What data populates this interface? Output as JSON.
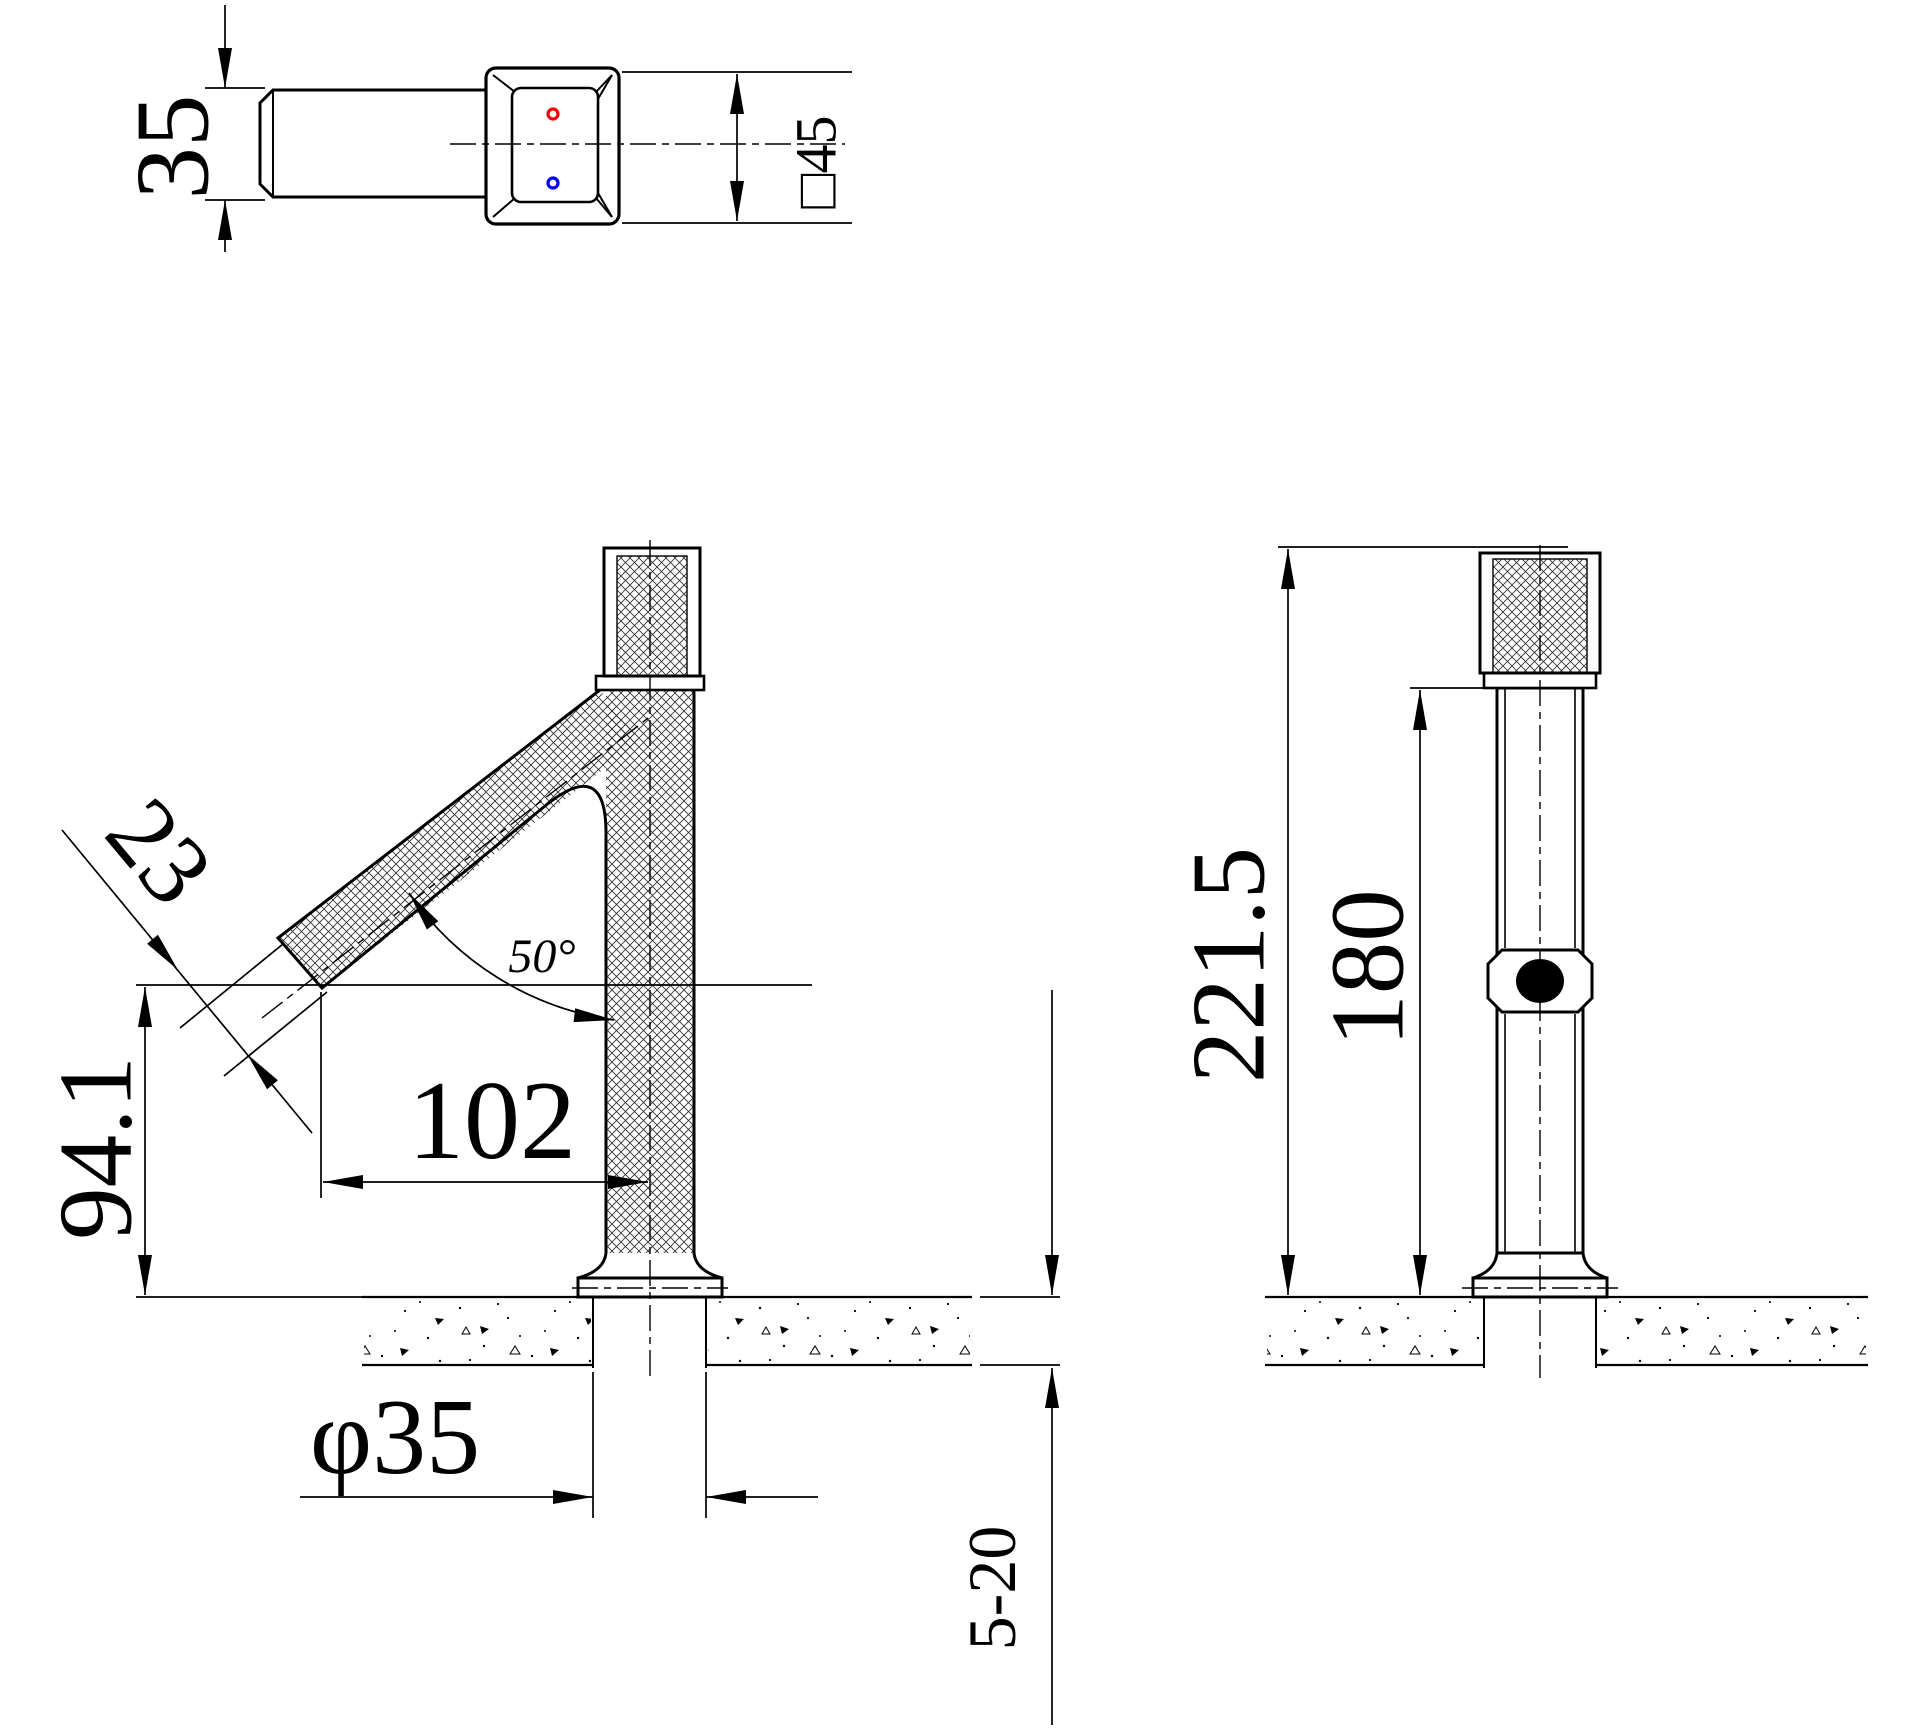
{
  "drawing": {
    "type": "technical-cad-drawing",
    "subject": "single-handle basin faucet, three orthographic views with dimensions",
    "colors": {
      "line": "#000000",
      "hot_dot": "#ff0000",
      "cold_dot": "#0000ff",
      "background": "#ffffff"
    },
    "labels": {
      "top_width": "35",
      "head_size": "□45",
      "spout_width": "23",
      "spout_angle": "50°",
      "spout_height": "94.1",
      "reach": "102",
      "shank_dia": "φ35",
      "deck_range": "5-20",
      "total_height": "221.5",
      "body_height": "180"
    }
  }
}
